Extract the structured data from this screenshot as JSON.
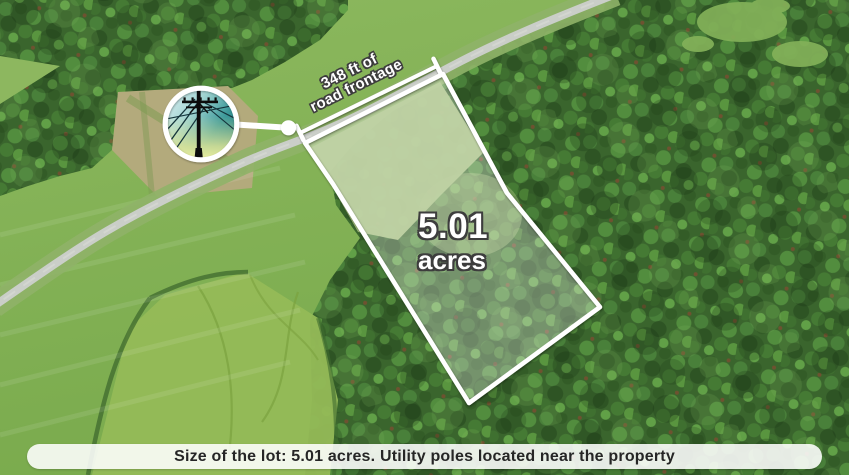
{
  "annotations": {
    "frontage": {
      "line1": "348 ft of",
      "line2": "road frontage"
    },
    "acreage": {
      "value": "5.01",
      "unit": "acres"
    },
    "caption": "Size of the lot: 5.01 acres. Utility poles located near the property"
  },
  "inset": {
    "subject": "utility pole photo"
  },
  "colors": {
    "field": "#7fae52",
    "forest": "#3a652d",
    "road": "#cacec8",
    "clearing": "#b3aa7c",
    "lot-overlay": "rgba(255,255,255,0.30)",
    "annotation-white": "#ffffff",
    "outline-dark": "#3d3d3d",
    "caption-bg": "rgba(255,255,255,0.88)",
    "caption-text": "#262626",
    "inset-sky-light": "#d2ebee",
    "inset-sky-teal": "#1d7a80",
    "inset-grass": "#e7ed9f"
  }
}
